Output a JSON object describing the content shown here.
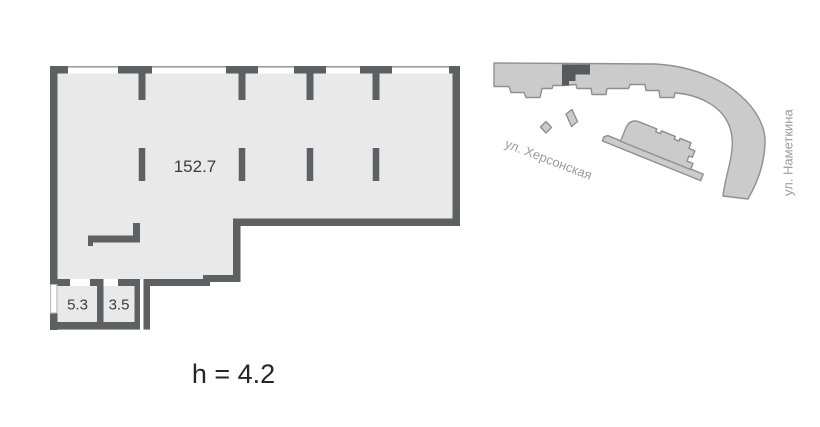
{
  "floor_plan": {
    "main_area_label": "152.7",
    "room_labels": [
      "5.3",
      "3.5"
    ],
    "ceiling_height_label": "h = 4.2",
    "label_color": "#3b3b3b",
    "height_label_color": "#262626",
    "wall_color": "#5e6061",
    "floor_fill_color": "#e9e9ea",
    "window_line_color": "#9c9c9c"
  },
  "site_plan": {
    "street_labels": [
      "ул. Херсонская",
      "ул. Наметкина"
    ],
    "street_label_color": "#9b9b9b",
    "building_fill_color": "#cbcbcc",
    "building_outline_color": "#8f8f8f",
    "unit_highlight_color": "#58595b"
  }
}
